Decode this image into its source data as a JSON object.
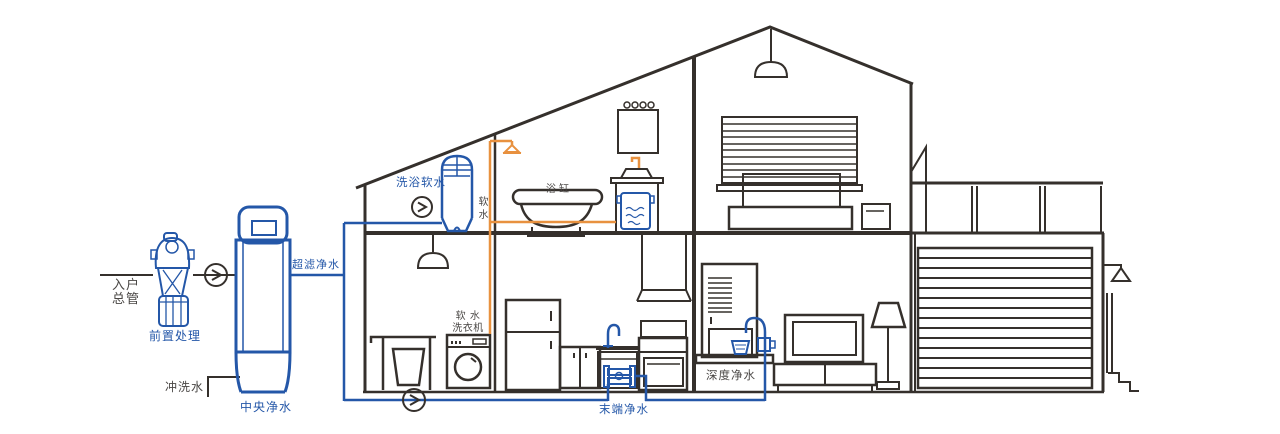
{
  "diagram": {
    "title": "whole-house water purification cutaway diagram",
    "colors": {
      "blue": "#2457a8",
      "orange": "#e8913f",
      "line": "#35302c",
      "text": "#4a4745"
    },
    "labels": {
      "inlet_main": "入户\n总管",
      "pre_treatment": "前置处理",
      "central_purifier": "中央净水",
      "ultrafiltration": "超滤净水",
      "flush_water": "冲洗水",
      "bath_softener": "洗浴软水",
      "soft_water": "软水",
      "bathtub": "浴缸",
      "soft_water_washer": "软 水\n洗衣机",
      "terminal_purifier": "末端净水",
      "deep_purifier": "深度净水"
    },
    "icons": [
      "flow-arrow-icon",
      "shower-icon",
      "outdoor-lamp-icon"
    ]
  }
}
